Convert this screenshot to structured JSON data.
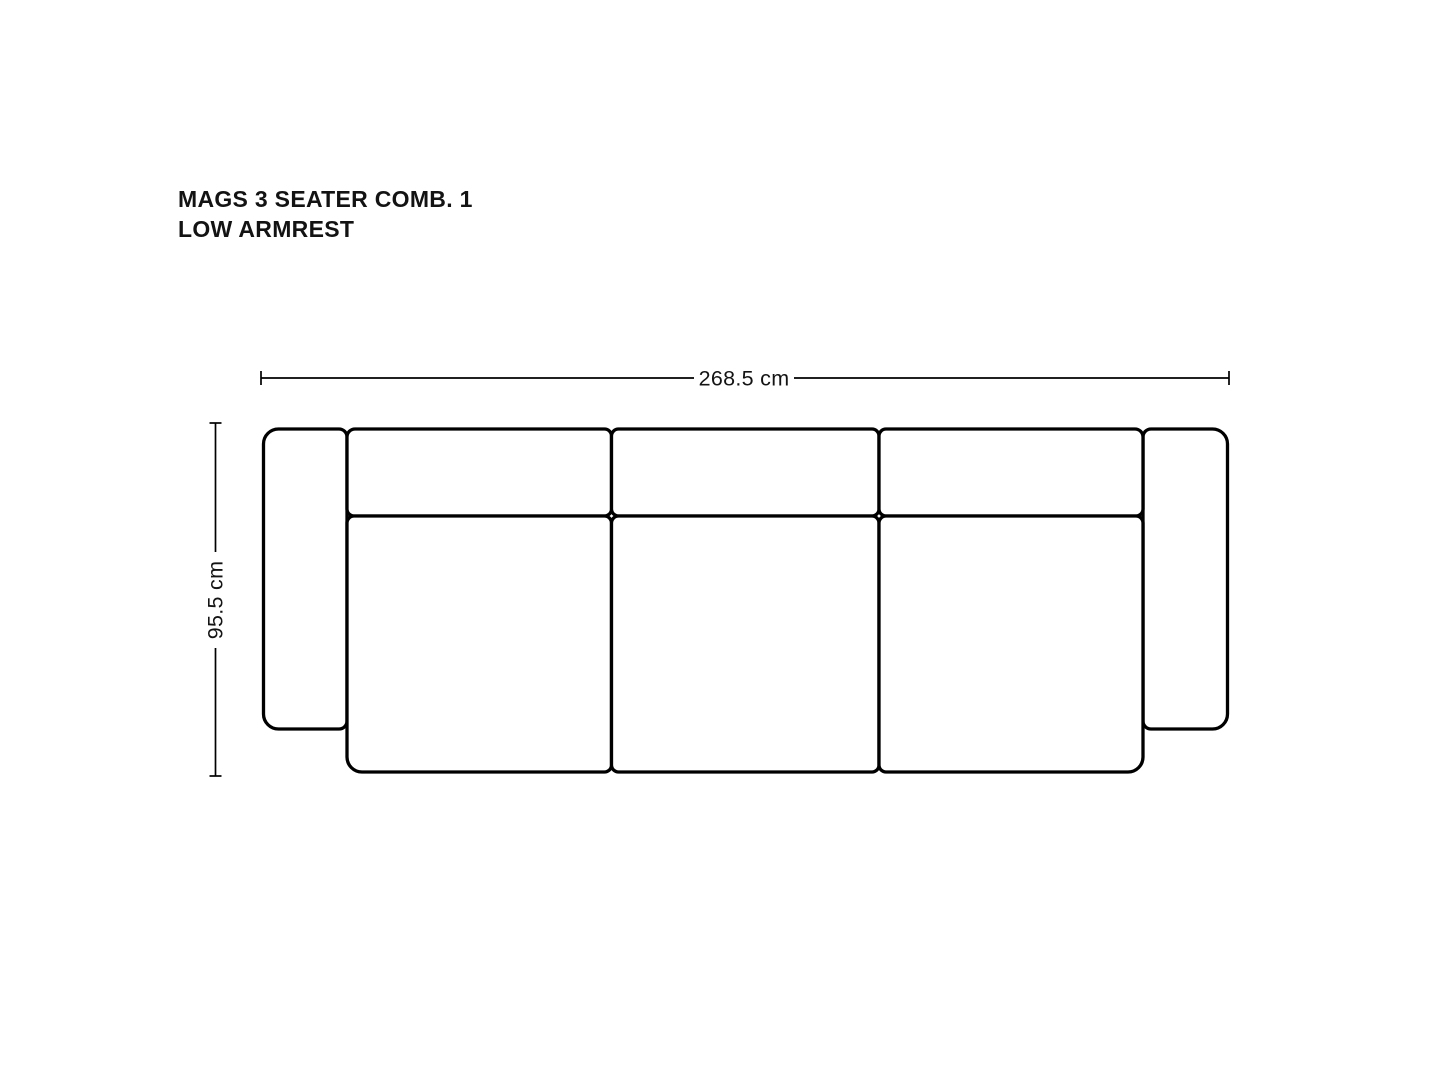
{
  "page": {
    "background": "#ffffff"
  },
  "title": {
    "line1": "MAGS 3 SEATER COMB. 1",
    "line2": "LOW ARMREST"
  },
  "dimensions": {
    "width": {
      "label": "268.5 cm",
      "value_cm": 268.5
    },
    "depth": {
      "label": "95.5 cm",
      "value_cm": 95.5
    }
  },
  "colors": {
    "background": "#ffffff",
    "outline": "#000000",
    "dimension_line": "#000000",
    "text": "#141414",
    "cushion_fill": "#ffffff"
  },
  "diagram": {
    "width_dim": {
      "x1": 261,
      "x2": 1229,
      "y": 378,
      "tick_half": 7,
      "cx": 744,
      "gap_half": 50
    },
    "depth_dim": {
      "x": 215.5,
      "y1": 423,
      "y2": 776,
      "tick_half": 6,
      "cy": 600,
      "gap_half": 48
    },
    "parts": [
      {
        "name": "left-armrest",
        "x": 263.5,
        "y": 429,
        "w": 83.5,
        "h": 300,
        "r": [
          15,
          8,
          8,
          15
        ]
      },
      {
        "name": "right-armrest",
        "x": 1143,
        "y": 429,
        "w": 84.5,
        "h": 300,
        "r": [
          8,
          15,
          15,
          8
        ]
      },
      {
        "name": "back-cushion-1",
        "x": 347,
        "y": 429,
        "w": 264.5,
        "h": 87,
        "r": [
          8,
          7,
          7,
          7
        ]
      },
      {
        "name": "back-cushion-2",
        "x": 611.5,
        "y": 429,
        "w": 267.5,
        "h": 87,
        "r": [
          7,
          7,
          7,
          7
        ]
      },
      {
        "name": "back-cushion-3",
        "x": 879,
        "y": 429,
        "w": 264,
        "h": 87,
        "r": [
          7,
          8,
          7,
          7
        ]
      },
      {
        "name": "seat-cushion-1",
        "x": 347,
        "y": 516,
        "w": 264.5,
        "h": 256,
        "r": [
          7,
          7,
          7,
          15
        ]
      },
      {
        "name": "seat-cushion-2",
        "x": 611.5,
        "y": 516,
        "w": 267.5,
        "h": 256,
        "r": [
          7,
          7,
          7,
          7
        ]
      },
      {
        "name": "seat-cushion-3",
        "x": 879,
        "y": 516,
        "w": 264,
        "h": 256,
        "r": [
          7,
          7,
          15,
          7
        ]
      }
    ]
  }
}
